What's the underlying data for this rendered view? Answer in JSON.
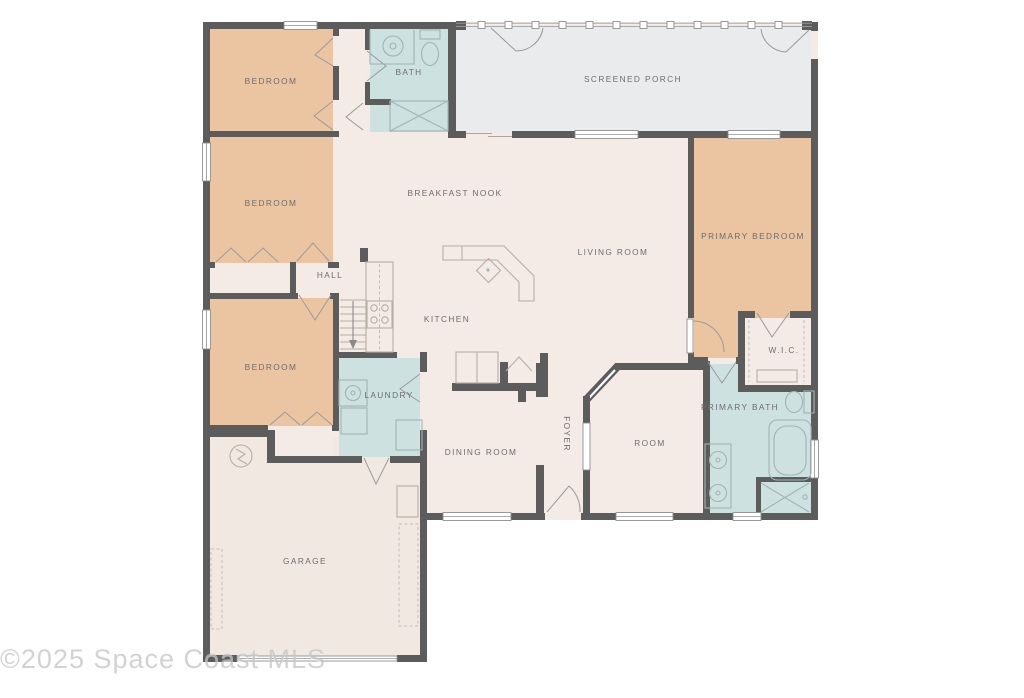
{
  "floorplan": {
    "watermark": "©2025 Space Coast MLS",
    "rooms": {
      "bedroom1": {
        "label": "BEDROOM"
      },
      "bath": {
        "label": "BATH"
      },
      "screened_porch": {
        "label": "SCREENED PORCH"
      },
      "bedroom2": {
        "label": "BEDROOM"
      },
      "breakfast_nook": {
        "label": "BREAKFAST NOOK"
      },
      "living_room": {
        "label": "LIVING ROOM"
      },
      "primary_bedroom": {
        "label": "PRIMARY BEDROOM"
      },
      "hall": {
        "label": "HALL"
      },
      "kitchen": {
        "label": "KITCHEN"
      },
      "bedroom3": {
        "label": "BEDROOM"
      },
      "laundry": {
        "label": "LAUNDRY"
      },
      "dining_room": {
        "label": "DINING ROOM"
      },
      "foyer": {
        "label": "FOYER"
      },
      "room": {
        "label": "ROOM"
      },
      "wic": {
        "label": "W.I.C."
      },
      "primary_bath": {
        "label": "PRIMARY BATH"
      },
      "garage": {
        "label": "GARAGE"
      }
    },
    "colors": {
      "wall": "#5c5c5c",
      "bedroom_fill": "#ebc4a2",
      "wet_fill": "#cee1e1",
      "living_fill": "#f4ebe6",
      "porch_fill": "#e9ebec",
      "garage_fill": "#f2e8e2",
      "label_text": "#6d6d6d",
      "watermark": "#c4c4c4"
    }
  }
}
